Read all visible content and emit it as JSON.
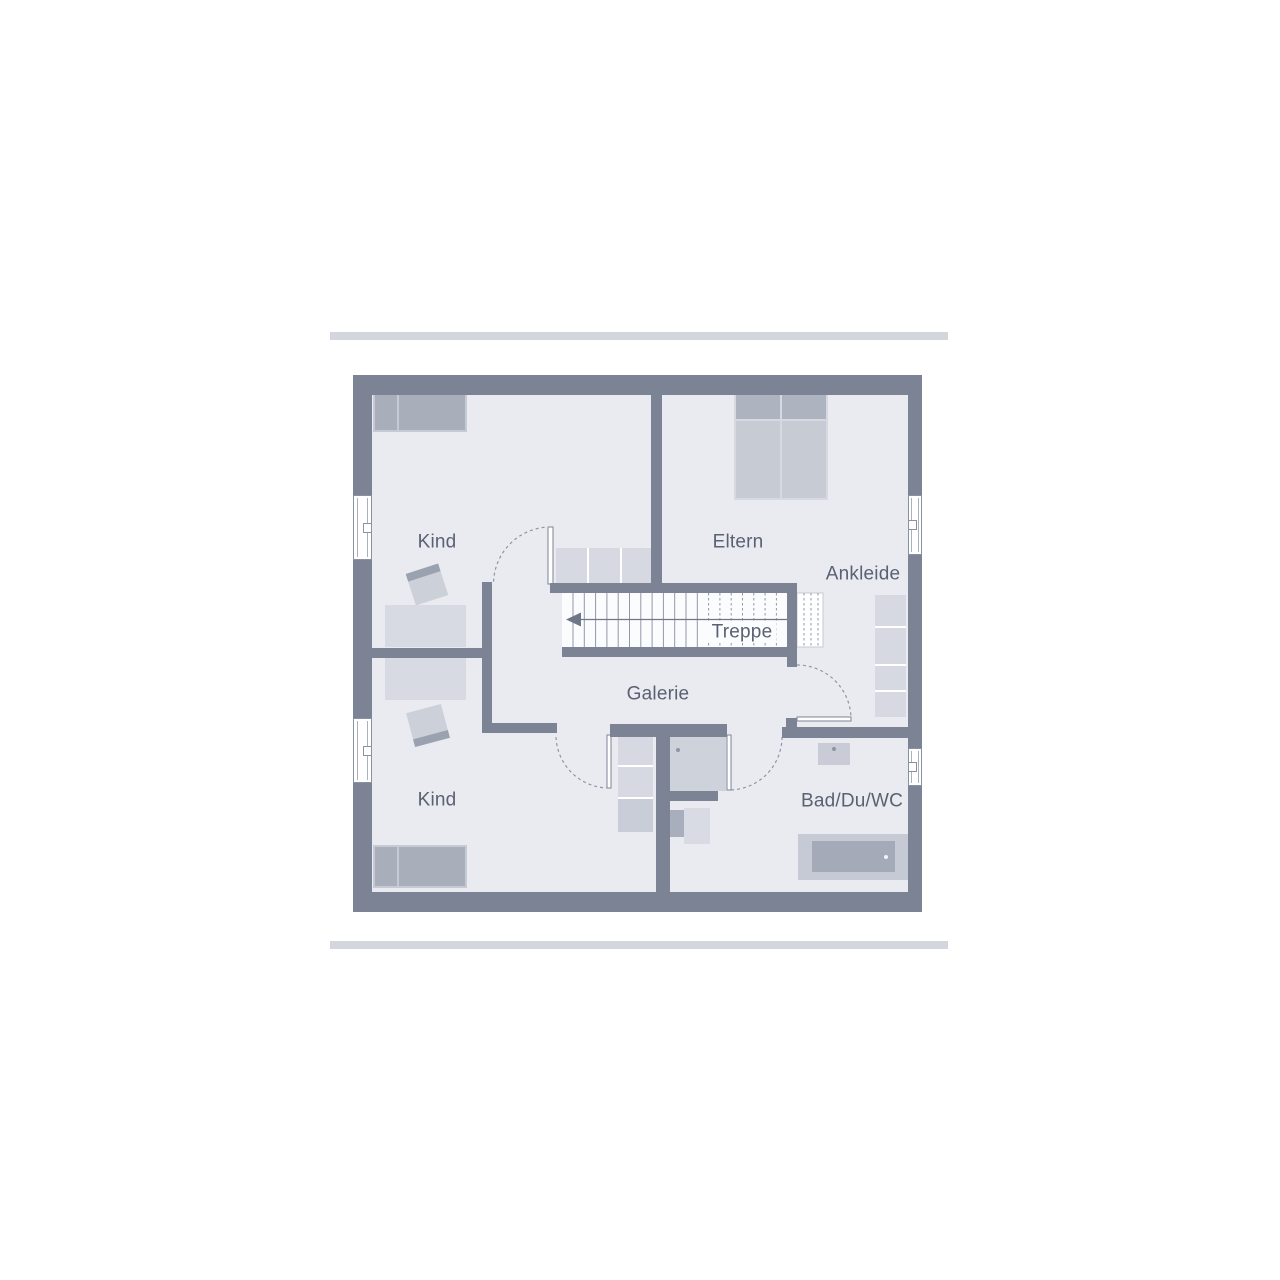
{
  "title": "Obergeschoss Grundriss",
  "floorplan": {
    "labels": {
      "kind_top": "Kind",
      "eltern": "Eltern",
      "ankleide": "Ankleide",
      "treppe": "Treppe",
      "galerie": "Galerie",
      "kind_bottom": "Kind",
      "bad": "Bad/Du/WC"
    },
    "stairs": {
      "label": "Treppe",
      "direction_arrow": "left"
    }
  },
  "palette": {
    "wall": "#7b8394",
    "floor": "#e9ebf1",
    "stair_field": "#fbfcfd",
    "stair_lines": "#9099a8",
    "furniture_light": "#d7dae2",
    "furniture_medium": "#a9aebb",
    "furniture_mid": "#c7cbd4",
    "dashed_lines": "#8e96a5",
    "text": "#5a6172",
    "deco_bar": "#d3d6dc",
    "background": "#ffffff"
  }
}
